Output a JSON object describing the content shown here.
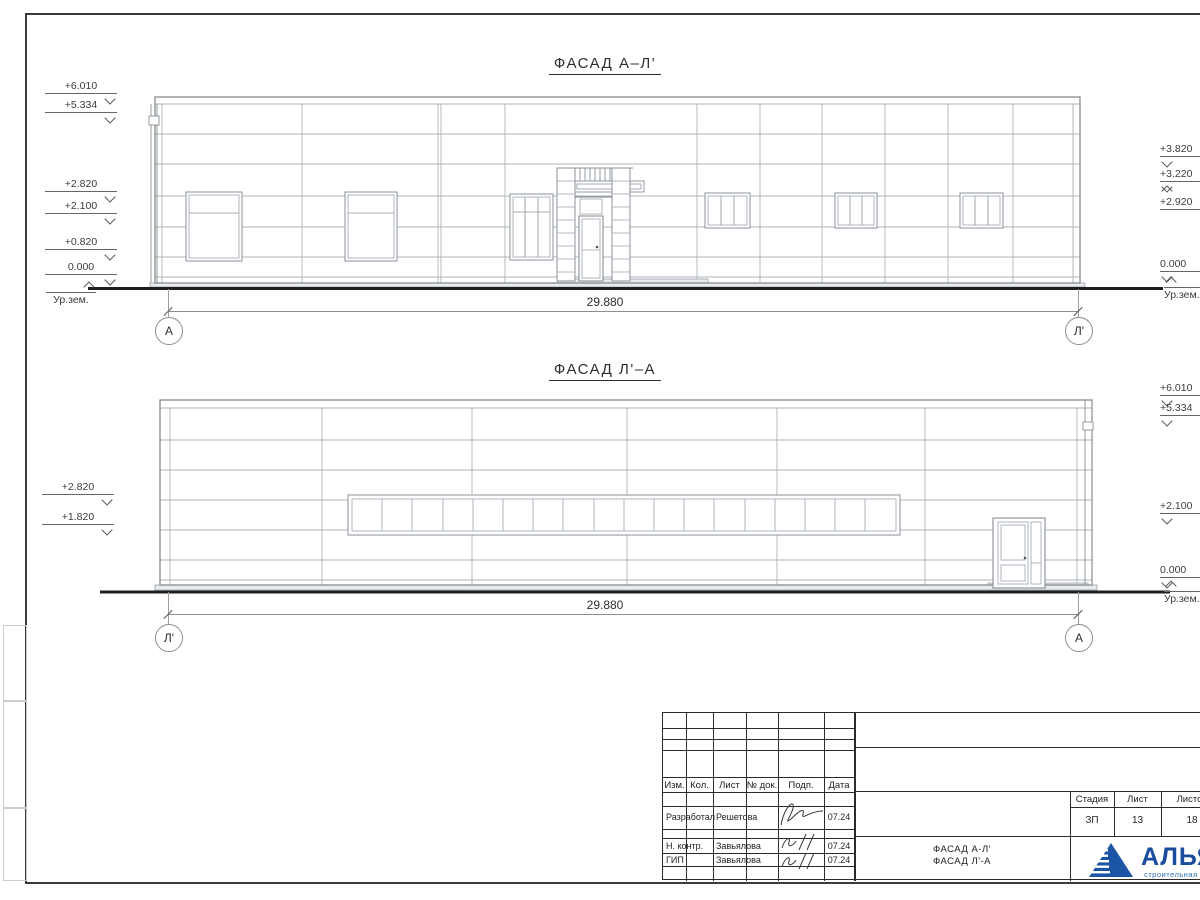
{
  "facade_top": {
    "title": "ФАСАД А–Л'",
    "dimension": "29.880",
    "axis_left": "А",
    "axis_right": "Л'",
    "marks_left": [
      "+6.010",
      "+5.334",
      "+2.820",
      "+2.100",
      "+0.820",
      "0.000"
    ],
    "ground_left": "Ур.зем.",
    "marks_right": [
      "+3.820",
      "+3.220",
      "+2.920",
      "0.000"
    ],
    "ground_right": "Ур.зем."
  },
  "facade_bottom": {
    "title": "ФАСАД Л'–А",
    "dimension": "29.880",
    "axis_left": "Л'",
    "axis_right": "А",
    "marks_left": [
      "+2.820",
      "+1.820"
    ],
    "marks_right": [
      "+6.010",
      "+5.334",
      "+2.100",
      "0.000"
    ],
    "ground_right": "Ур.зем."
  },
  "title_block": {
    "header_columns": [
      "Изм.",
      "Кол.",
      "Лист",
      "№ док.",
      "Подп.",
      "Дата"
    ],
    "rows": [
      {
        "role": "Разработал",
        "name": "Решетова",
        "date": "07.24"
      },
      {
        "role": "Н. контр.",
        "name": "Завьялова",
        "date": "07.24"
      },
      {
        "role": "ГИП",
        "name": "Завьялова",
        "date": "07.24"
      }
    ],
    "stage_label": "Стадия",
    "sheet_label": "Лист",
    "sheets_label": "Листов",
    "stage": "ЗП",
    "sheet_no": "13",
    "sheets_total": "18",
    "doc_title_line1": "ФАСАД А-Л'",
    "doc_title_line2": "ФАСАД Л'-А",
    "company": "АЛЬЯНС",
    "company_sub": "строительная компания",
    "brand_color": "#1b4c9c"
  }
}
